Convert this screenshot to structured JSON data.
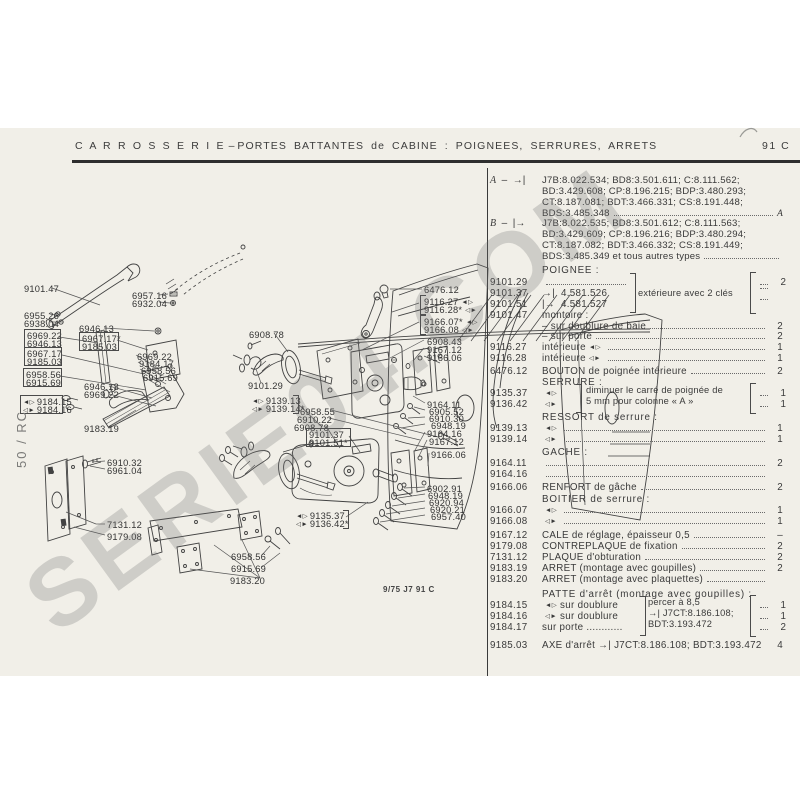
{
  "header": {
    "section": "C A R R O S S E R I E",
    "dash": "–",
    "title": "PORTES BATTANTES de CABINE : POIGNEES, SERRURES, ARRETS",
    "page_ref": "91 C"
  },
  "watermark": "SERIE04.COM",
  "side_note": "50 / RC",
  "footnote": "9/75 J7 91 C",
  "icons": {
    "left": "◄▷",
    "right": "◁►",
    "to_bar": "→|",
    "from_bar": "|→"
  },
  "ab": [
    {
      "label": "A",
      "dash": "–",
      "icon": "→|",
      "y": 175,
      "lines": [
        "J7B:8.022.534; BD8:3.501.611; C:8.111.562;",
        "BD:3.429.608; CP:8.196.215; BDP:3.480.293;",
        "CT:8.187.081; BDT:3.466.331; CS:8.191.448;",
        "BDS:3.485.348"
      ],
      "trail": "A"
    },
    {
      "label": "B",
      "dash": "–",
      "icon": "|→",
      "y": 218,
      "lines": [
        "J7B:8.022.535; BD8:3.501.612; C:8.111.563;",
        "BD:3.429.609; CP:8.196.216; BDP:3.480.294;",
        "CT:8.187.082; BDT:3.466.332; CS:8.191.449;",
        "BDS:3.485.349 et tous autres types"
      ],
      "trail": ""
    }
  ],
  "list": {
    "rows": [
      {
        "y": 265,
        "heading": "POIGNEE :"
      },
      {
        "y": 310,
        "ref": "9101.47",
        "text": "montoire :"
      },
      {
        "y": 321,
        "text": "– sur doublure de baie",
        "dots": true,
        "qty": "2"
      },
      {
        "y": 331,
        "text": "– sur porte",
        "dots": true,
        "qty": "2"
      },
      {
        "y": 342,
        "ref": "9116.27",
        "text": "intérieure",
        "post": "L",
        "dots": true,
        "qty": "1"
      },
      {
        "y": 353,
        "ref": "9116.28",
        "text": "intérieure",
        "post": "R",
        "dots": true,
        "qty": "1"
      },
      {
        "y": 366,
        "ref": "6476.12",
        "text": "BOUTON de poignée intérieure",
        "dots": true,
        "qty": "2"
      },
      {
        "y": 377,
        "heading": "SERRURE :"
      },
      {
        "y": 412,
        "heading": "RESSORT de serrure :"
      },
      {
        "y": 423,
        "ref": "9139.13",
        "pre": "L",
        "dots": true,
        "qty": "1"
      },
      {
        "y": 434,
        "ref": "9139.14",
        "pre": "R",
        "dots": true,
        "qty": "1"
      },
      {
        "y": 447,
        "heading": "GACHE :"
      },
      {
        "y": 458,
        "ref": "9164.11",
        "dots": true,
        "qty": "2"
      },
      {
        "y": 469,
        "ref": "9164.16",
        "dots": true,
        "qty": ""
      },
      {
        "y": 482,
        "ref": "9166.06",
        "text": "RENFORT de gâche",
        "dots": true,
        "qty": "2"
      },
      {
        "y": 494,
        "heading": "BOITIER de serrure :"
      },
      {
        "y": 505,
        "ref": "9166.07",
        "pre": "L",
        "dots": true,
        "qty": "1"
      },
      {
        "y": 516,
        "ref": "9166.08",
        "pre": "R",
        "dots": true,
        "qty": "1"
      },
      {
        "y": 530,
        "ref": "9167.12",
        "text": "CALE de réglage, épaisseur 0,5",
        "dots": true,
        "qty": "–"
      },
      {
        "y": 541,
        "ref": "9179.08",
        "text": "CONTREPLAQUE de fixation",
        "dots": true,
        "qty": "2"
      },
      {
        "y": 552,
        "ref": "7131.12",
        "text": "PLAQUE d'obturation",
        "dots": true,
        "qty": "2"
      },
      {
        "y": 563,
        "ref": "9183.19",
        "text": "ARRET (montage avec goupilles)",
        "dots": true,
        "qty": "2"
      },
      {
        "y": 574,
        "ref": "9183.20",
        "text": "ARRET (montage avec plaquettes)",
        "dots": true,
        "qty": ""
      },
      {
        "y": 589,
        "heading": "PATTE d'arrêt (montage avec goupilles) :"
      },
      {
        "y": 640,
        "ref": "9185.03",
        "text": "AXE d'arrêt  →|  J7CT:8.186.108; BDT:3.193.472",
        "qty": "4"
      }
    ],
    "groups": [
      {
        "y": 277,
        "rows": [
          {
            "ref": "9101.29",
            "dots": true
          },
          {
            "ref": "9101.37",
            "icon": "→|",
            "text": "4.581.526"
          },
          {
            "ref": "9101.51",
            "icon": "|→",
            "text": "4.581.527"
          }
        ],
        "label": "extérieure avec 2 clés",
        "qtys": [
          "2",
          "",
          ""
        ]
      },
      {
        "y": 388,
        "rows": [
          {
            "ref": "9135.37",
            "pre": "L"
          },
          {
            "ref": "9136.42",
            "pre": "R"
          }
        ],
        "lines": [
          "diminuer le carré de poignée de",
          "5 mm pour colonne « A »"
        ],
        "qtys": [
          "1",
          "1"
        ]
      },
      {
        "y": 600,
        "rows": [
          {
            "ref": "9184.15",
            "pre": "L",
            "text": "sur doublure"
          },
          {
            "ref": "9184.16",
            "pre": "R",
            "text": "sur doublure"
          },
          {
            "ref": "9184.17",
            "text": "sur porte ............"
          }
        ],
        "lines": [
          "percer à 8,5",
          "→|  J7CT:8.186.108;",
          "BDT:3.193.472"
        ],
        "qtys": [
          "1",
          "1",
          "2"
        ]
      }
    ]
  },
  "diagram": {
    "labels": [
      {
        "t": "9101.47",
        "x": 24,
        "y": 284
      },
      {
        "t": "6957.16",
        "x": 132,
        "y": 291
      },
      {
        "t": "6932.04",
        "x": 132,
        "y": 299
      },
      {
        "t": "6955.26",
        "x": 24,
        "y": 311
      },
      {
        "t": "6938.04",
        "x": 24,
        "y": 319
      },
      {
        "t": "6946.13",
        "x": 79,
        "y": 324
      },
      {
        "t": "6969.22",
        "x": 27,
        "y": 331
      },
      {
        "t": "6946.13",
        "x": 27,
        "y": 339
      },
      {
        "t": "6967.17*",
        "x": 82,
        "y": 334
      },
      {
        "t": "9185.03",
        "x": 82,
        "y": 342
      },
      {
        "t": "6967.17",
        "x": 27,
        "y": 349
      },
      {
        "t": "9185.03",
        "x": 27,
        "y": 357
      },
      {
        "t": "6969.22",
        "x": 137,
        "y": 352
      },
      {
        "t": "9184.17",
        "x": 139,
        "y": 359
      },
      {
        "t": "6958.56",
        "x": 141,
        "y": 366
      },
      {
        "t": "6915.69",
        "x": 143,
        "y": 373
      },
      {
        "t": "6958.56",
        "x": 26,
        "y": 370
      },
      {
        "t": "6915.69",
        "x": 26,
        "y": 378
      },
      {
        "t": "9184.15",
        "x": 23,
        "y": 397,
        "pre": "L"
      },
      {
        "t": "9184.16",
        "x": 23,
        "y": 405,
        "pre": "R"
      },
      {
        "t": "6946.13",
        "x": 84,
        "y": 382
      },
      {
        "t": "6969.22",
        "x": 84,
        "y": 390
      },
      {
        "t": "9183.19",
        "x": 84,
        "y": 424
      },
      {
        "t": "6910.32",
        "x": 107,
        "y": 458
      },
      {
        "t": "6961.04",
        "x": 107,
        "y": 466
      },
      {
        "t": "7131.12",
        "x": 107,
        "y": 520
      },
      {
        "t": "9179.08",
        "x": 107,
        "y": 532
      },
      {
        "t": "6908.78",
        "x": 249,
        "y": 330
      },
      {
        "t": "9101.29",
        "x": 248,
        "y": 381
      },
      {
        "t": "9139.13",
        "x": 252,
        "y": 396,
        "pre": "L"
      },
      {
        "t": "9139.14*",
        "x": 252,
        "y": 404,
        "pre": "R"
      },
      {
        "t": "6958.55",
        "x": 300,
        "y": 407
      },
      {
        "t": "6910.22",
        "x": 297,
        "y": 415
      },
      {
        "t": "6908.78",
        "x": 294,
        "y": 423
      },
      {
        "t": "9101.37",
        "x": 309,
        "y": 430
      },
      {
        "t": "9101.51*",
        "x": 309,
        "y": 438
      },
      {
        "t": "9135.37",
        "x": 296,
        "y": 511,
        "pre": "L"
      },
      {
        "t": "9136.42*",
        "x": 296,
        "y": 519,
        "pre": "R"
      },
      {
        "t": "6958.56",
        "x": 231,
        "y": 552
      },
      {
        "t": "6915.69",
        "x": 231,
        "y": 564
      },
      {
        "t": "9183.20",
        "x": 230,
        "y": 576
      },
      {
        "t": "6476.12",
        "x": 424,
        "y": 285
      },
      {
        "t": "9116.27",
        "x": 424,
        "y": 297,
        "post": "L"
      },
      {
        "t": "9116.28*",
        "x": 424,
        "y": 305,
        "post": "R"
      },
      {
        "t": "9166.07*",
        "x": 424,
        "y": 317,
        "post": "L"
      },
      {
        "t": "9166.08",
        "x": 424,
        "y": 325,
        "post": "R"
      },
      {
        "t": "6908.43",
        "x": 427,
        "y": 337
      },
      {
        "t": "9167.12",
        "x": 427,
        "y": 345
      },
      {
        "t": "9166.06",
        "x": 427,
        "y": 353
      },
      {
        "t": "9164.11",
        "x": 427,
        "y": 400
      },
      {
        "t": "6905.52",
        "x": 429,
        "y": 407
      },
      {
        "t": "6910.30",
        "x": 429,
        "y": 414
      },
      {
        "t": "6948.19",
        "x": 431,
        "y": 421
      },
      {
        "t": "9164.16",
        "x": 427,
        "y": 429
      },
      {
        "t": "9167.12",
        "x": 429,
        "y": 437
      },
      {
        "t": "9166.06",
        "x": 431,
        "y": 450
      },
      {
        "t": "6902.91",
        "x": 427,
        "y": 484
      },
      {
        "t": "6948.19",
        "x": 428,
        "y": 491
      },
      {
        "t": "6920.94",
        "x": 429,
        "y": 498
      },
      {
        "t": "6920.21",
        "x": 430,
        "y": 505
      },
      {
        "t": "6957.40",
        "x": 431,
        "y": 512
      }
    ],
    "boxes": [
      {
        "x": 24,
        "y": 329,
        "w": 35,
        "h": 17
      },
      {
        "x": 79,
        "y": 332,
        "w": 38,
        "h": 17
      },
      {
        "x": 24,
        "y": 347,
        "w": 36,
        "h": 17
      },
      {
        "x": 23,
        "y": 368,
        "w": 37,
        "h": 17
      },
      {
        "x": 20,
        "y": 395,
        "w": 41,
        "h": 17
      },
      {
        "x": 306,
        "y": 428,
        "w": 43,
        "h": 17
      }
    ],
    "brackets": [
      {
        "x": 420,
        "y": 295,
        "h": 18,
        "side": "open"
      },
      {
        "x": 420,
        "y": 315,
        "h": 18,
        "side": "open"
      },
      {
        "x": 293,
        "y": 395,
        "h": 17,
        "side": "close"
      },
      {
        "x": 343,
        "y": 510,
        "h": 17,
        "side": "close"
      }
    ]
  }
}
